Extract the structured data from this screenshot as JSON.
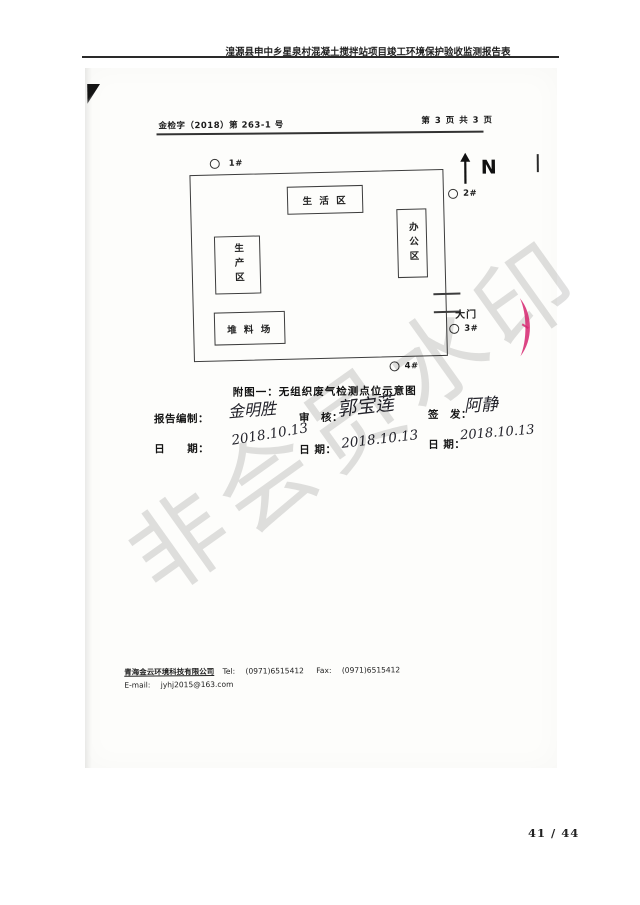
{
  "header": {
    "title": "湟源县申中乡星泉村混凝土搅拌站项目竣工环境保护验收监测报告表"
  },
  "doc": {
    "ref_number": "金检字（2018）第 263-1 号",
    "page_indicator": "第 3 页 共 3 页",
    "north_label": "N",
    "points": {
      "p1": "1#",
      "p2": "2#",
      "p3": "3#",
      "p4": "4#"
    },
    "zones": {
      "living": "生 活 区",
      "office": "办公区",
      "production": "生产区",
      "stockyard": "堆 料 场"
    },
    "gate_label": "大门",
    "caption": "附图一：无组织废气检测点位示意图",
    "signoff": {
      "prepared_label": "报告编制：",
      "prepared_signature": "金明胜",
      "prepared_date_label": "日　　期：",
      "prepared_date": "2018.10.13",
      "review_label": "审　核：",
      "review_signature": "郭宝莲",
      "review_date_label": "日 期：",
      "review_date": "2018.10.13",
      "issue_label": "签　发：",
      "issue_signature": "阿静",
      "issue_date_label": "日 期：",
      "issue_date": "2018.10.13"
    },
    "watermark": "非会员水印",
    "footer": {
      "company": "青海金云环境科技有限公司",
      "tel_label": "Tel:",
      "tel_value": "(0971)6515412",
      "fax_label": "Fax:",
      "fax_value": "(0971)6515412",
      "email_label": "E-mail:",
      "email_value": "jyhj2015@163.com"
    }
  },
  "page_number": "41 / 44",
  "colors": {
    "stamp_red": "#d6246e",
    "ink": "#1b1b1b"
  }
}
